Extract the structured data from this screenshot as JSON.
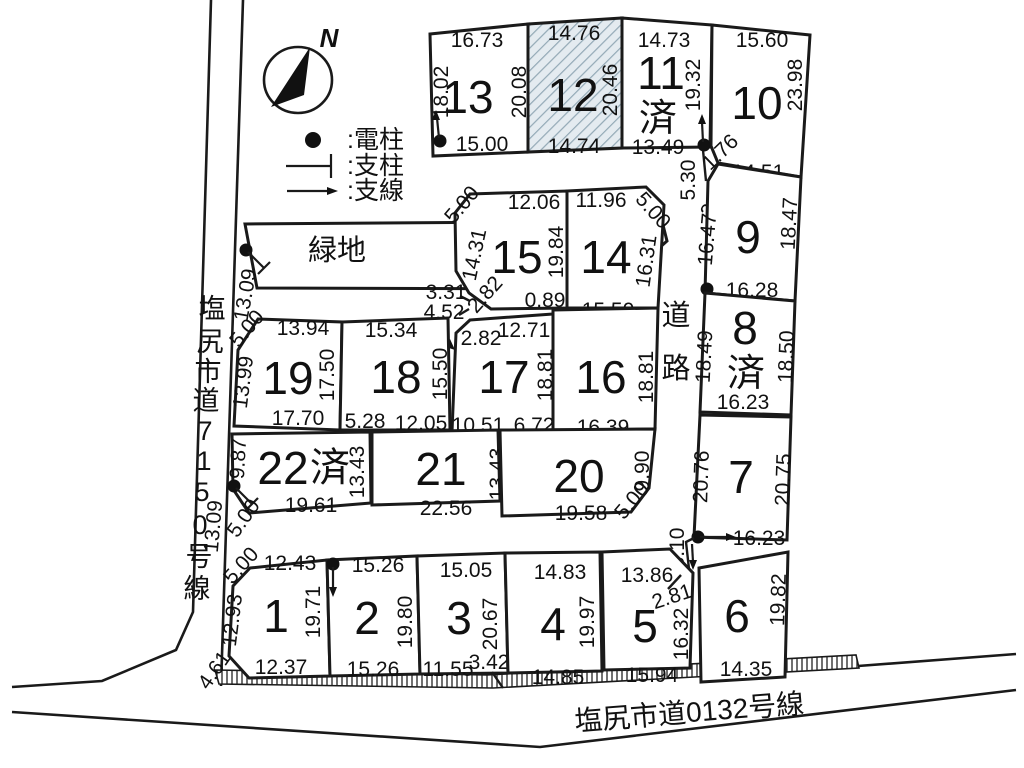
{
  "compass": {
    "north": "N"
  },
  "legend": {
    "pole": ":電柱",
    "post": ":支柱",
    "wire": ":支線"
  },
  "green_space": {
    "label": "緑地"
  },
  "roads": {
    "left_chars": [
      "塩",
      "尻",
      "市",
      "道",
      "7",
      "1",
      "5",
      "0",
      "号",
      "線"
    ],
    "bottom_name": "塩尻市道0132号線",
    "inner_chars": [
      "道",
      "路"
    ]
  },
  "lots": {
    "1": {
      "no": "1",
      "top_left": "5.00",
      "top": "12.43",
      "left": "12.93",
      "right": "19.71",
      "bottom": "12.37",
      "bottom_left": "4.61"
    },
    "2": {
      "no": "2",
      "top": "15.26",
      "right": "19.80",
      "bottom": "15.26"
    },
    "3": {
      "no": "3",
      "top": "15.05",
      "right": "20.67",
      "bottom": "11.55",
      "bottom_right": "3.42"
    },
    "4": {
      "no": "4",
      "top": "14.83",
      "right": "19.97",
      "bottom": "14.85"
    },
    "5": {
      "no": "5",
      "top": "13.86",
      "top_right": "2.81",
      "right": "16.32",
      "bottom": "15.94"
    },
    "6": {
      "no": "6",
      "right": "19.82",
      "bottom": "14.35"
    },
    "7": {
      "no": "7",
      "left": "20.76",
      "right": "20.75",
      "bottom": "16.23"
    },
    "8": {
      "no": "8",
      "status": "済",
      "left": "18.49",
      "right": "18.50",
      "bottom": "16.23"
    },
    "9": {
      "no": "9",
      "left": "16.47",
      "right": "18.47",
      "bottom": "16.28"
    },
    "10": {
      "no": "10",
      "top": "15.60",
      "right": "23.98",
      "bottom": "14.51"
    },
    "11": {
      "no": "11",
      "status": "済",
      "top": "14.73",
      "right": "19.32",
      "bottom": "13.49"
    },
    "12": {
      "no": "12",
      "top": "14.76",
      "right": "20.46",
      "bottom": "14.74"
    },
    "13": {
      "no": "13",
      "top": "16.73",
      "left": "18.02",
      "right": "20.08",
      "bottom": "15.00"
    },
    "14": {
      "no": "14",
      "top": "11.96",
      "top_right": "5.00",
      "right": "16.31",
      "bottom": "15.50"
    },
    "15": {
      "no": "15",
      "top_left": "5.00",
      "top": "12.06",
      "left": "14.31",
      "right": "19.84",
      "bottom": "0.89"
    },
    "16": {
      "no": "16",
      "right": "18.81",
      "bottom": "16.39"
    },
    "17": {
      "no": "17",
      "top": "12.71",
      "top_left_diag": "2.82",
      "right": "18.81",
      "bottom": "10.51",
      "bottom_right": "6.72"
    },
    "18": {
      "no": "18",
      "top": "15.34",
      "right": "15.50",
      "bottom_left": "5.28",
      "bottom": "12.05"
    },
    "19": {
      "no": "19",
      "top_left": "5.00",
      "top": "13.94",
      "left": "13.99",
      "right": "17.50",
      "bottom": "17.70"
    },
    "20": {
      "no": "20",
      "right": "9.90",
      "bottom_right": "5.00",
      "bottom": "19.58"
    },
    "21": {
      "no": "21",
      "right": "13.43",
      "bottom": "22.56"
    },
    "22": {
      "no": "22",
      "status": "済",
      "left": "9.87",
      "right": "13.43",
      "bottom": "19.61"
    }
  },
  "segments": {
    "s1_76": "1.76",
    "s5_30": "5.30",
    "s2_82_9": "2.82",
    "s3_10": "3.10",
    "s3_31": "3.31",
    "s4_52": "4.52",
    "s2_82_15": "2.82",
    "s13_09_upper": "13.09",
    "s13_09_lower": "13.09",
    "s5_00_22": "5.00"
  },
  "colors": {
    "line": "#1a1a1a",
    "lot12_fill": "#e4ebf0",
    "lot12_hatch": "#93a9b6"
  }
}
